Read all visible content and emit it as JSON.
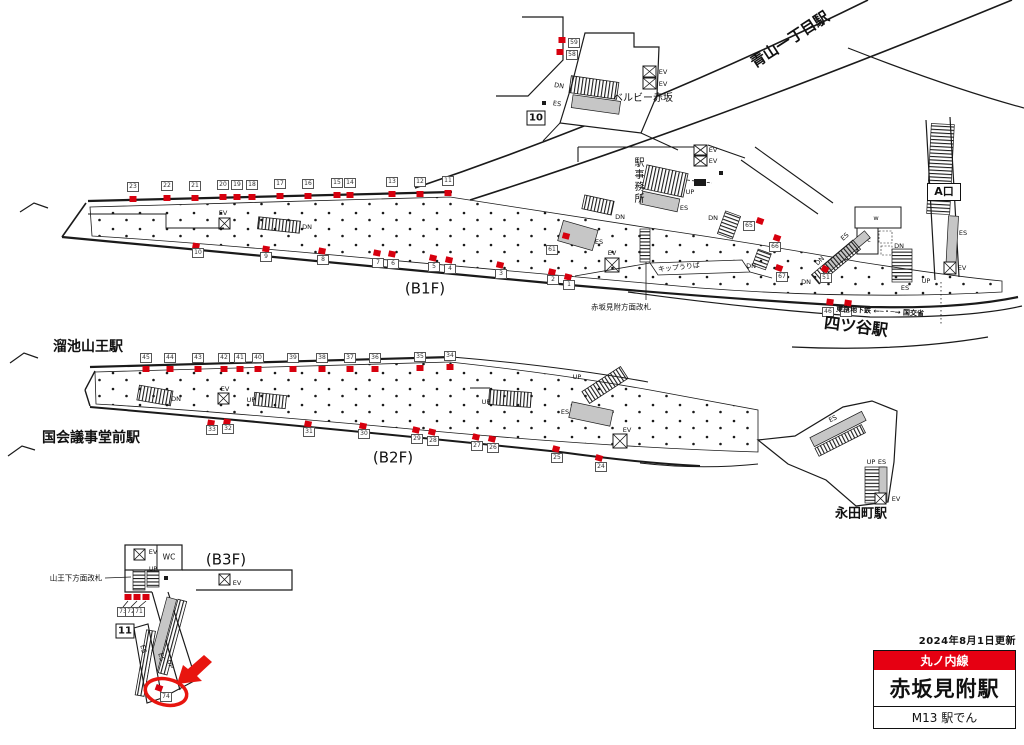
{
  "legend": {
    "updated": "2024年8月1日更新",
    "line": "丸ノ内線",
    "station": "赤坂見附駅",
    "code": "M13 駅でん"
  },
  "colors": {
    "ad_red": "#d7000e",
    "accent_red": "#e60012",
    "escalator_gray": "#c6c6c6",
    "line_black": "#1a1a1a"
  },
  "signs": [
    {
      "name": "platform-10-sign",
      "text": "10",
      "x": 536,
      "y": 118,
      "w": 17,
      "h": 13,
      "fs": 10
    },
    {
      "name": "platform-11-sign",
      "text": "11",
      "x": 125,
      "y": 631,
      "w": 17,
      "h": 13,
      "fs": 10
    },
    {
      "name": "exit-a-sign",
      "text": "A口",
      "x": 944,
      "y": 192,
      "w": 32,
      "h": 16,
      "fs": 11
    }
  ],
  "labels": [
    {
      "name": "aoyama-itchome-station",
      "text": "青山一丁目駅",
      "x": 790,
      "y": 40,
      "s": 15,
      "b": 1,
      "r": -33
    },
    {
      "name": "bellevie-akasaka",
      "text": "ベルビー赤坂",
      "x": 643,
      "y": 99,
      "s": 10,
      "b": 0,
      "r": 0
    },
    {
      "name": "station-office",
      "text": "駅事務所",
      "x": 637,
      "y": 181,
      "s": 10,
      "b": 0,
      "r": 0,
      "v": 1
    },
    {
      "name": "yotsuya-station",
      "text": "四ツ谷駅",
      "x": 856,
      "y": 327,
      "s": 16,
      "b": 1,
      "r": 7
    },
    {
      "name": "tokyo-metro-mlit",
      "text": "東京地下鉄 ←─・─→ 国交省",
      "x": 880,
      "y": 312,
      "s": 7,
      "b": 1,
      "r": 3
    },
    {
      "name": "tameike-sanno-station",
      "text": "溜池山王駅",
      "x": 88,
      "y": 347,
      "s": 14,
      "b": 1,
      "r": 0
    },
    {
      "name": "kokkai-gijidomae-station",
      "text": "国会議事堂前駅",
      "x": 91,
      "y": 438,
      "s": 14,
      "b": 1,
      "r": 0
    },
    {
      "name": "nagatacho-station",
      "text": "永田町駅",
      "x": 861,
      "y": 514,
      "s": 13,
      "b": 1,
      "r": 0
    },
    {
      "name": "b1f-label",
      "text": "(B1F)",
      "x": 425,
      "y": 289,
      "s": 15,
      "b": 0,
      "r": 0
    },
    {
      "name": "b2f-label",
      "text": "(B2F)",
      "x": 393,
      "y": 458,
      "s": 15,
      "b": 0,
      "r": 0
    },
    {
      "name": "b3f-label",
      "text": "(B3F)",
      "x": 226,
      "y": 560,
      "s": 15,
      "b": 0,
      "r": 0
    },
    {
      "name": "sanno-gate-label",
      "text": "山王下方面改札",
      "x": 76,
      "y": 578,
      "s": 7.5,
      "b": 0,
      "r": 0
    },
    {
      "name": "akasaka-gate-label",
      "text": "赤坂見附方面改札",
      "x": 621,
      "y": 307,
      "s": 7.5,
      "b": 0,
      "r": 0
    },
    {
      "name": "ticket-office-label",
      "text": "キップうりば",
      "x": 679,
      "y": 268,
      "s": 7,
      "b": 0,
      "r": -6
    },
    {
      "name": "wc-label",
      "text": "WC",
      "x": 169,
      "y": 557,
      "s": 7.5,
      "b": 0,
      "r": 0
    },
    {
      "name": "w-room-label",
      "text": "w",
      "x": 876,
      "y": 218,
      "s": 6.5,
      "b": 0,
      "r": 0
    },
    {
      "name": "c-room-label",
      "text": "c",
      "x": 869,
      "y": 240,
      "s": 6.5,
      "b": 0,
      "r": 0
    },
    {
      "name": "ev-label",
      "text": "EV",
      "x": 663,
      "y": 72,
      "s": 6.5,
      "b": 0,
      "r": 0
    },
    {
      "name": "ev-label",
      "text": "EV",
      "x": 663,
      "y": 84,
      "s": 6.5,
      "b": 0,
      "r": 0
    },
    {
      "name": "dn-label",
      "text": "DN",
      "x": 559,
      "y": 86,
      "s": 6.5,
      "b": 0,
      "r": 8
    },
    {
      "name": "es-label",
      "text": "ES",
      "x": 557,
      "y": 104,
      "s": 6.5,
      "b": 0,
      "r": 8
    },
    {
      "name": "ev-label",
      "text": "EV",
      "x": 223,
      "y": 213,
      "s": 6.5,
      "b": 0,
      "r": 0
    },
    {
      "name": "dn-label",
      "text": "DN",
      "x": 307,
      "y": 227,
      "s": 6.5,
      "b": 0,
      "r": 0
    },
    {
      "name": "up-label",
      "text": "UP",
      "x": 690,
      "y": 192,
      "s": 6.5,
      "b": 0,
      "r": 0
    },
    {
      "name": "es-label",
      "text": "ES",
      "x": 684,
      "y": 208,
      "s": 6.5,
      "b": 0,
      "r": 0
    },
    {
      "name": "dn-label",
      "text": "DN",
      "x": 620,
      "y": 217,
      "s": 6.5,
      "b": 0,
      "r": 0
    },
    {
      "name": "ev-label",
      "text": "EV",
      "x": 713,
      "y": 150,
      "s": 6.5,
      "b": 0,
      "r": 0
    },
    {
      "name": "ev-label",
      "text": "EV",
      "x": 713,
      "y": 161,
      "s": 6.5,
      "b": 0,
      "r": 0
    },
    {
      "name": "es-label",
      "text": "ES",
      "x": 599,
      "y": 242,
      "s": 6.5,
      "b": 0,
      "r": 0
    },
    {
      "name": "ev-label",
      "text": "EV",
      "x": 612,
      "y": 253,
      "s": 6.5,
      "b": 0,
      "r": 0
    },
    {
      "name": "dn-label",
      "text": "DN",
      "x": 713,
      "y": 218,
      "s": 6.5,
      "b": 0,
      "r": 0
    },
    {
      "name": "dn-label",
      "text": "DN",
      "x": 751,
      "y": 266,
      "s": 6.5,
      "b": 0,
      "r": 0
    },
    {
      "name": "dn-label",
      "text": "DN",
      "x": 820,
      "y": 261,
      "s": 6.5,
      "b": 0,
      "r": -45
    },
    {
      "name": "es-label",
      "text": "ES",
      "x": 845,
      "y": 237,
      "s": 6.5,
      "b": 0,
      "r": -42
    },
    {
      "name": "dn-label",
      "text": "DN",
      "x": 806,
      "y": 282,
      "s": 6.5,
      "b": 0,
      "r": 0
    },
    {
      "name": "dn-label",
      "text": "DN",
      "x": 899,
      "y": 246,
      "s": 6.5,
      "b": 0,
      "r": 0
    },
    {
      "name": "es-label",
      "text": "ES",
      "x": 905,
      "y": 288,
      "s": 6.5,
      "b": 0,
      "r": 0
    },
    {
      "name": "es-label",
      "text": "ES",
      "x": 963,
      "y": 233,
      "s": 6.5,
      "b": 0,
      "r": 0
    },
    {
      "name": "up-label",
      "text": "UP",
      "x": 926,
      "y": 281,
      "s": 6.5,
      "b": 0,
      "r": 0
    },
    {
      "name": "ev-label",
      "text": "EV",
      "x": 962,
      "y": 268,
      "s": 6.5,
      "b": 0,
      "r": 0
    },
    {
      "name": "dn-label",
      "text": "DN",
      "x": 176,
      "y": 399,
      "s": 6.5,
      "b": 0,
      "r": 0
    },
    {
      "name": "ev-label",
      "text": "EV",
      "x": 225,
      "y": 389,
      "s": 6.5,
      "b": 0,
      "r": 0
    },
    {
      "name": "up-label",
      "text": "UP",
      "x": 251,
      "y": 400,
      "s": 6.5,
      "b": 0,
      "r": 0
    },
    {
      "name": "up-label",
      "text": "UP",
      "x": 486,
      "y": 402,
      "s": 6.5,
      "b": 0,
      "r": 0
    },
    {
      "name": "up-label",
      "text": "UP",
      "x": 577,
      "y": 377,
      "s": 6.5,
      "b": 0,
      "r": 0
    },
    {
      "name": "es-label",
      "text": "ES",
      "x": 565,
      "y": 412,
      "s": 6.5,
      "b": 0,
      "r": 0
    },
    {
      "name": "ev-label",
      "text": "EV",
      "x": 627,
      "y": 430,
      "s": 6.5,
      "b": 0,
      "r": 0
    },
    {
      "name": "es-label",
      "text": "ES",
      "x": 833,
      "y": 419,
      "s": 6.5,
      "b": 0,
      "r": -27
    },
    {
      "name": "up-label",
      "text": "UP",
      "x": 871,
      "y": 462,
      "s": 6.5,
      "b": 0,
      "r": 0
    },
    {
      "name": "es-label",
      "text": "ES",
      "x": 882,
      "y": 462,
      "s": 6.5,
      "b": 0,
      "r": 0
    },
    {
      "name": "ev-label",
      "text": "EV",
      "x": 896,
      "y": 499,
      "s": 6.5,
      "b": 0,
      "r": 0
    },
    {
      "name": "ev-label",
      "text": "EV",
      "x": 153,
      "y": 552,
      "s": 6.5,
      "b": 0,
      "r": 0
    },
    {
      "name": "up-label",
      "text": "UP",
      "x": 153,
      "y": 570,
      "s": 6,
      "b": 0,
      "r": 0
    },
    {
      "name": "ev-label",
      "text": "EV",
      "x": 237,
      "y": 583,
      "s": 6.5,
      "b": 0,
      "r": 0
    },
    {
      "name": "es-label",
      "text": "ES",
      "x": 143,
      "y": 649,
      "s": 6.5,
      "b": 0,
      "r": 75
    },
    {
      "name": "es-label",
      "text": "ES",
      "x": 161,
      "y": 657,
      "s": 6.5,
      "b": 0,
      "r": 75
    },
    {
      "name": "up-label",
      "text": "UP",
      "x": 170,
      "y": 664,
      "s": 6.5,
      "b": 0,
      "r": 75
    }
  ],
  "ad_markers": [
    {
      "n": "23",
      "bx": 133,
      "by": 187,
      "rx": 133,
      "ry": 199
    },
    {
      "n": "22",
      "bx": 167,
      "by": 186,
      "rx": 167,
      "ry": 198
    },
    {
      "n": "21",
      "bx": 195,
      "by": 186,
      "rx": 195,
      "ry": 198
    },
    {
      "n": "20",
      "bx": 223,
      "by": 185,
      "rx": 223,
      "ry": 197
    },
    {
      "n": "19",
      "bx": 237,
      "by": 185,
      "rx": 237,
      "ry": 197
    },
    {
      "n": "18",
      "bx": 252,
      "by": 185,
      "rx": 252,
      "ry": 197
    },
    {
      "n": "17",
      "bx": 280,
      "by": 184,
      "rx": 280,
      "ry": 196
    },
    {
      "n": "16",
      "bx": 308,
      "by": 184,
      "rx": 308,
      "ry": 196
    },
    {
      "n": "15",
      "bx": 337,
      "by": 183,
      "rx": 337,
      "ry": 195
    },
    {
      "n": "14",
      "bx": 350,
      "by": 183,
      "rx": 350,
      "ry": 195
    },
    {
      "n": "13",
      "bx": 392,
      "by": 182,
      "rx": 392,
      "ry": 194
    },
    {
      "n": "12",
      "bx": 420,
      "by": 182,
      "rx": 420,
      "ry": 194
    },
    {
      "n": "11",
      "bx": 448,
      "by": 181,
      "rx": 448,
      "ry": 193
    },
    {
      "n": "10",
      "bx": 198,
      "by": 253,
      "rx": 196,
      "ry": 246,
      "rot": 10
    },
    {
      "n": "9",
      "bx": 266,
      "by": 257,
      "rx": 266,
      "ry": 249,
      "rot": 10
    },
    {
      "n": "8",
      "bx": 323,
      "by": 260,
      "rx": 322,
      "ry": 251,
      "rot": 12
    },
    {
      "n": "7",
      "bx": 378,
      "by": 263,
      "rx": 377,
      "ry": 253,
      "rot": 12
    },
    {
      "n": "6",
      "bx": 393,
      "by": 264,
      "rx": 392,
      "ry": 254,
      "rot": 12
    },
    {
      "n": "5",
      "bx": 434,
      "by": 267,
      "rx": 433,
      "ry": 258,
      "rot": 13
    },
    {
      "n": "4",
      "bx": 450,
      "by": 269,
      "rx": 449,
      "ry": 260,
      "rot": 13
    },
    {
      "n": "3",
      "bx": 501,
      "by": 274,
      "rx": 500,
      "ry": 265,
      "rot": 14
    },
    {
      "n": "2",
      "bx": 553,
      "by": 280,
      "rx": 552,
      "ry": 272,
      "rot": 14
    },
    {
      "n": "1",
      "bx": 569,
      "by": 285,
      "rx": 568,
      "ry": 277,
      "rot": 14
    },
    {
      "n": "59",
      "bx": 574,
      "by": 43,
      "rx": 562,
      "ry": 40
    },
    {
      "n": "58",
      "bx": 572,
      "by": 55,
      "rx": 560,
      "ry": 52
    },
    {
      "n": "61",
      "bx": 552,
      "by": 250,
      "rx": 566,
      "ry": 236,
      "rot": 15
    },
    {
      "n": "65",
      "bx": 749,
      "by": 226,
      "rx": 760,
      "ry": 221,
      "rot": 20
    },
    {
      "n": "66",
      "bx": 775,
      "by": 247,
      "rx": 777,
      "ry": 238,
      "rot": 20
    },
    {
      "n": "67",
      "bx": 782,
      "by": 277,
      "rx": 779,
      "ry": 268,
      "rot": 20
    },
    {
      "n": "51",
      "bx": 826,
      "by": 278,
      "rx": 825,
      "ry": 269,
      "rot": 30
    },
    {
      "n": "46",
      "bx": 828,
      "by": 312,
      "rx": 830,
      "ry": 302,
      "rot": 8
    },
    {
      "n": "48",
      "bx": 846,
      "by": 312,
      "rx": 848,
      "ry": 303,
      "rot": 8
    },
    {
      "n": "45",
      "bx": 146,
      "by": 358,
      "rx": 146,
      "ry": 369
    },
    {
      "n": "44",
      "bx": 170,
      "by": 358,
      "rx": 170,
      "ry": 369
    },
    {
      "n": "43",
      "bx": 198,
      "by": 358,
      "rx": 198,
      "ry": 369
    },
    {
      "n": "42",
      "bx": 224,
      "by": 358,
      "rx": 224,
      "ry": 369
    },
    {
      "n": "41",
      "bx": 240,
      "by": 358,
      "rx": 240,
      "ry": 369
    },
    {
      "n": "40",
      "bx": 258,
      "by": 358,
      "rx": 258,
      "ry": 369
    },
    {
      "n": "39",
      "bx": 293,
      "by": 358,
      "rx": 293,
      "ry": 369
    },
    {
      "n": "38",
      "bx": 322,
      "by": 358,
      "rx": 322,
      "ry": 369
    },
    {
      "n": "37",
      "bx": 350,
      "by": 358,
      "rx": 350,
      "ry": 369
    },
    {
      "n": "36",
      "bx": 375,
      "by": 358,
      "rx": 375,
      "ry": 369
    },
    {
      "n": "35",
      "bx": 420,
      "by": 357,
      "rx": 420,
      "ry": 368
    },
    {
      "n": "34",
      "bx": 450,
      "by": 356,
      "rx": 450,
      "ry": 367
    },
    {
      "n": "33",
      "bx": 212,
      "by": 430,
      "rx": 211,
      "ry": 423,
      "rot": 10
    },
    {
      "n": "32",
      "bx": 228,
      "by": 429,
      "rx": 227,
      "ry": 422,
      "rot": 10
    },
    {
      "n": "31",
      "bx": 309,
      "by": 432,
      "rx": 308,
      "ry": 424,
      "rot": 12
    },
    {
      "n": "30",
      "bx": 364,
      "by": 434,
      "rx": 363,
      "ry": 426,
      "rot": 12
    },
    {
      "n": "29",
      "bx": 417,
      "by": 439,
      "rx": 416,
      "ry": 430,
      "rot": 14
    },
    {
      "n": "28",
      "bx": 433,
      "by": 441,
      "rx": 432,
      "ry": 432,
      "rot": 14
    },
    {
      "n": "27",
      "bx": 477,
      "by": 446,
      "rx": 476,
      "ry": 437,
      "rot": 15
    },
    {
      "n": "26",
      "bx": 493,
      "by": 448,
      "rx": 492,
      "ry": 439,
      "rot": 15
    },
    {
      "n": "25",
      "bx": 557,
      "by": 458,
      "rx": 556,
      "ry": 449,
      "rot": 15
    },
    {
      "n": "24",
      "bx": 601,
      "by": 467,
      "rx": 599,
      "ry": 458,
      "rot": 16
    },
    {
      "n": "73",
      "bx": 123,
      "by": 612,
      "rx": 128,
      "ry": 597
    },
    {
      "n": "72",
      "bx": 131,
      "by": 612,
      "rx": 137,
      "ry": 597
    },
    {
      "n": "71",
      "bx": 139,
      "by": 612,
      "rx": 146,
      "ry": 597
    },
    {
      "n": "74",
      "bx": 166,
      "by": 697,
      "rx": 159,
      "ry": 688,
      "rot": 20
    }
  ]
}
